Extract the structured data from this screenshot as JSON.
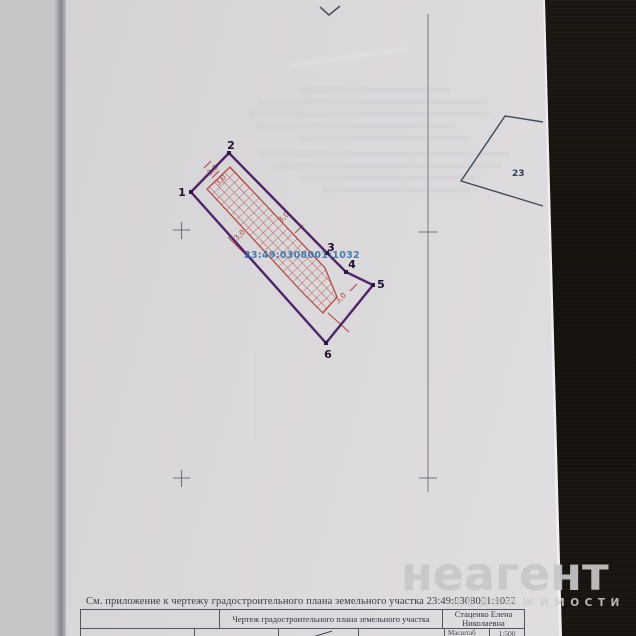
{
  "watermark": {
    "logo": "неагент",
    "tagline": "НЕДВИЖИМОСТИ"
  },
  "drawing": {
    "parcel_number": "23:49:0308001:1032",
    "vertices": [
      "1",
      "2",
      "3",
      "4",
      "5",
      "6"
    ],
    "dims": [
      "3,0",
      "3,0",
      "3,0",
      "3,0",
      "3,0"
    ],
    "neighbor_label": "23"
  },
  "footer": {
    "note": "См. приложение к чертежу градостроительного плана земельного участка 23:49:0308001:1032",
    "title_block": {
      "drawing_title": "Чертеж градостроительного плана земельного участка",
      "author_line1": "Стаценко Елена",
      "author_line2": "Николаевна",
      "scale_label": "Масштаб",
      "scale_value": "1:500"
    }
  },
  "colors": {
    "boundary": "#4f2568",
    "hatch": "#b0443c",
    "cad_text": "#3872aa",
    "neighbor": "#3d4b5a"
  }
}
